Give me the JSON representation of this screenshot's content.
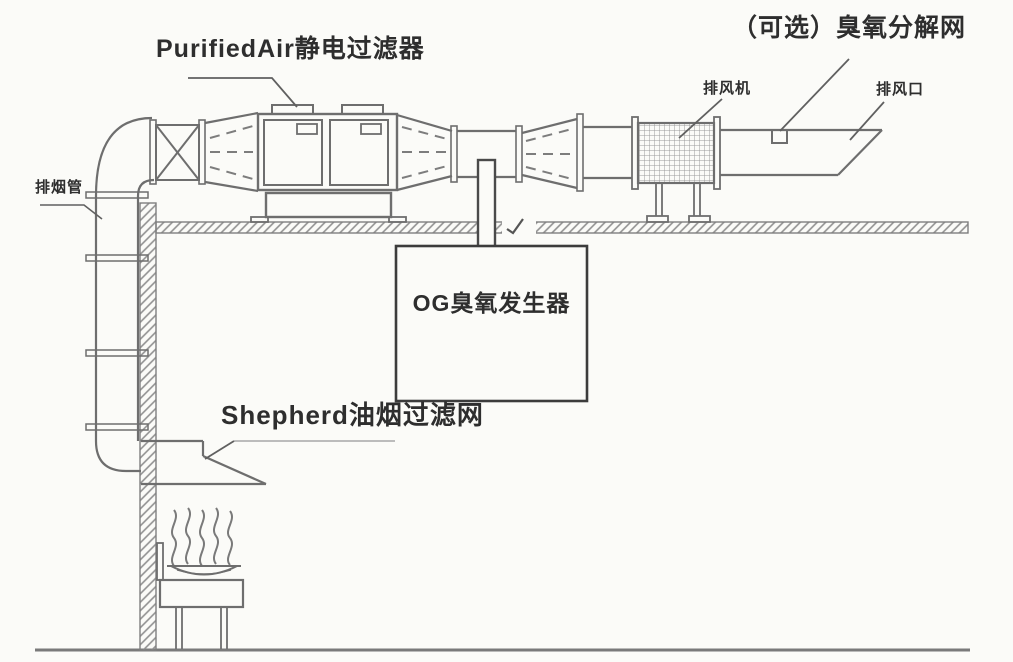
{
  "diagram_type": "kitchen-exhaust-purification-system",
  "colors": {
    "background": "#fbfbf8",
    "line": "#6e6e6e",
    "dark_line": "#4a4a4a",
    "hatch": "#909090",
    "text": "#2e2e2e"
  },
  "labels": {
    "electrostatic_filter": "PurifiedAir静电过滤器",
    "ozone_decomposition_net": "（可选）臭氧分解网",
    "exhaust_fan": "排风机",
    "exhaust_outlet": "排风口",
    "smoke_exhaust_pipe": "排烟管",
    "ozone_generator": "OG臭氧发生器",
    "oil_smoke_filter": "Shepherd油烟过滤网"
  }
}
